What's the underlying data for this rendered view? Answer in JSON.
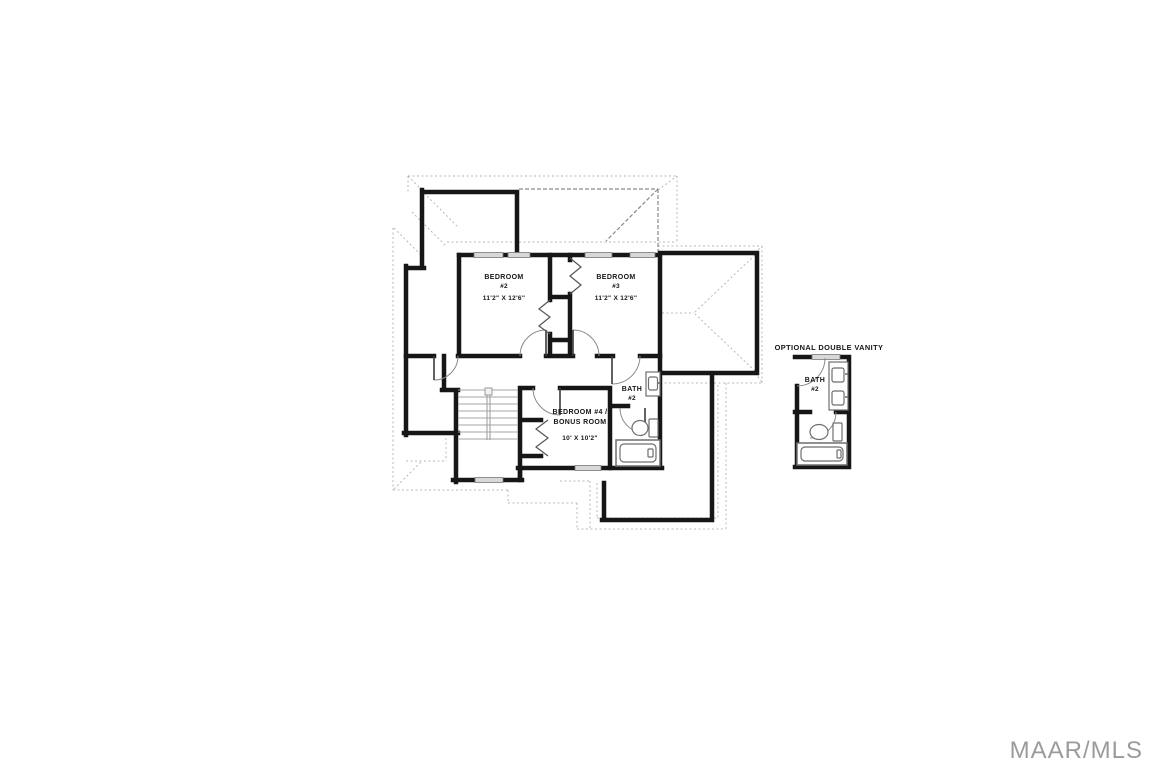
{
  "document": {
    "type": "floor-plan",
    "floor": "second-floor"
  },
  "rooms": {
    "bedroom2": {
      "name": "BEDROOM",
      "number": "#2",
      "dimensions": "11'2\" X 12'6\""
    },
    "bedroom3": {
      "name": "BEDROOM",
      "number": "#3",
      "dimensions": "11'2\" X 12'6\""
    },
    "bedroom4": {
      "name_line1": "BEDROOM #4 /",
      "name_line2": "BONUS ROOM",
      "dimensions": "10' X 10'2\""
    },
    "bath2": {
      "name": "BATH",
      "number": "#2"
    }
  },
  "inset": {
    "title": "OPTIONAL DOUBLE VANITY",
    "bath": {
      "name": "BATH",
      "number": "#2"
    }
  },
  "watermark": {
    "text": "MAAR/MLS",
    "color": "#9b9b9b"
  },
  "fixtures": {
    "main_bath": [
      "vanity-sink",
      "toilet",
      "bathtub"
    ],
    "inset_bath": [
      "double-vanity-sink",
      "double-vanity-sink",
      "toilet",
      "bathtub"
    ],
    "other": [
      "staircase",
      "bifold-closet-doors",
      "door-swings",
      "windows"
    ]
  },
  "colors": {
    "wall": "#161616",
    "window_fill": "#d8d8d8",
    "window_stroke": "#787878",
    "roof_dotted": "#b8b8b8",
    "roof_dashed": "#8a8a8a",
    "door_arc": "#8a8a8a",
    "fixture_stroke": "#6e6e6e",
    "stair_tread": "#a6a6a6",
    "background": "#ffffff"
  }
}
